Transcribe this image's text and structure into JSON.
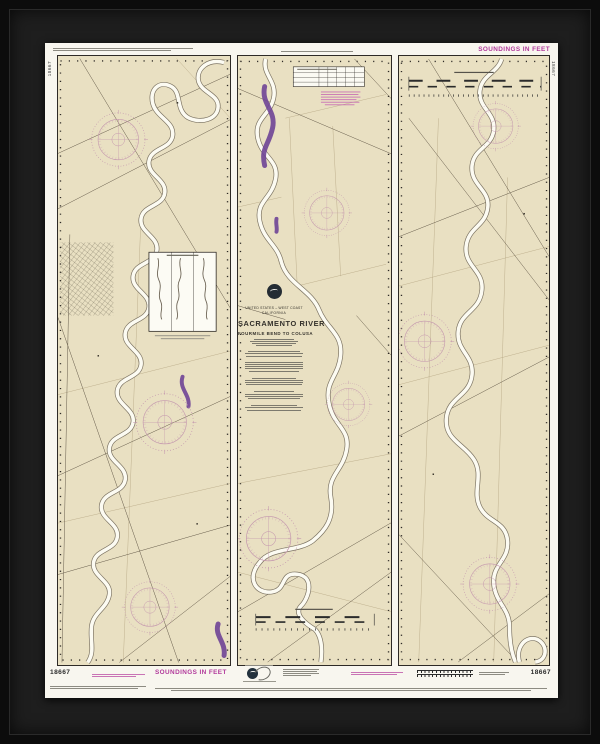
{
  "chart": {
    "number": "18667",
    "soundings_note": "SOUNDINGS IN FEET",
    "title_block": {
      "nation_line": "UNITED STATES – WEST COAST",
      "state_line": "CALIFORNIA",
      "title": "SACRAMENTO RIVER",
      "subtitle": "FOURMILE BEND TO COLUSA"
    }
  },
  "icons": {
    "noaa_logo": "noaa-logo-icon: dark circle with white seabird",
    "anniversary_emblem": "anniversary-emblem-icon: small dark circle with gray swirl ring",
    "compass_rose": "compass-rose-icon: pink graduated double circle"
  },
  "colors": {
    "chart_magenta": "#b23a9c",
    "land_tan": "#e9e0c2",
    "river_white": "#fcfbf2",
    "caution_purple": "#6f4496",
    "compass_rose_pink": "#c497ae",
    "frame_black": "#0c0c0c",
    "mat_charcoal": "#1e1e1e",
    "sheet_white": "#f8f6ef"
  }
}
